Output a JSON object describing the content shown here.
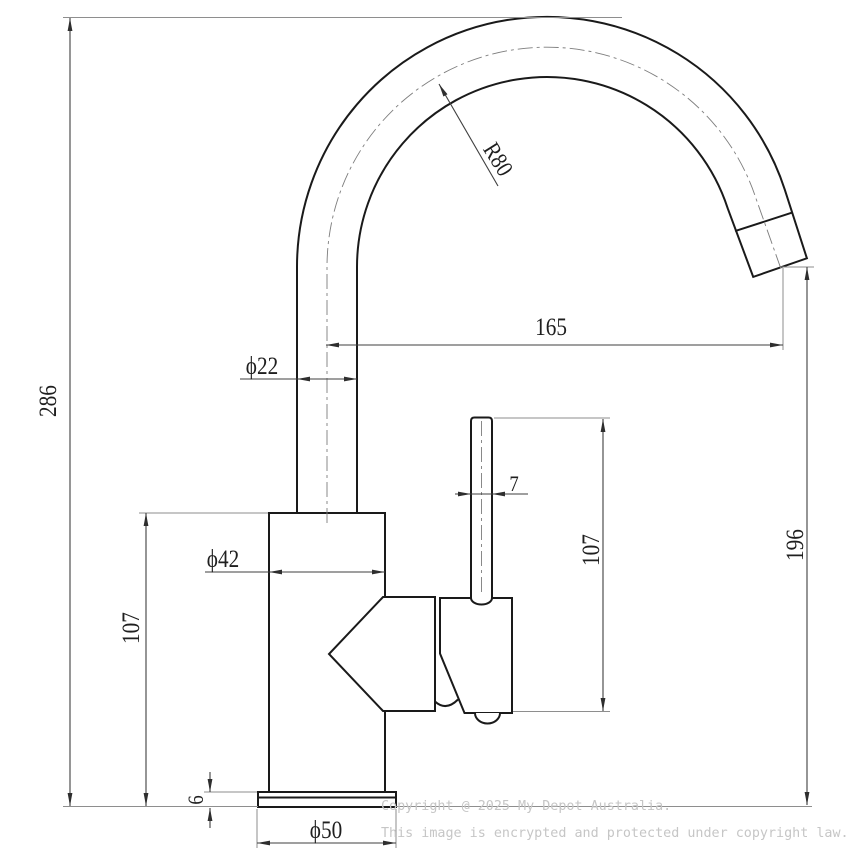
{
  "drawing": {
    "type": "technical-dimension-drawing",
    "subject": "gooseneck-mixer-tap-side-view",
    "dimensions": {
      "overall_height": "286",
      "body_height": "107",
      "base_plate_thickness": "6",
      "base_diameter": "ϕ50",
      "body_diameter": "ϕ42",
      "spout_pipe_diameter": "ϕ22",
      "spout_reach": "165",
      "spout_bend_radius": "R80",
      "lever_thickness": "7",
      "lever_height": "107",
      "outlet_height": "196"
    },
    "watermark": {
      "line1": "Copyright @ 2025 My Depot Australia.",
      "line2": "This image is encrypted and protected under copyright law."
    },
    "colors": {
      "background": "#ffffff",
      "outline": "#1a1a1a",
      "dimension_line": "#3f3f3f",
      "extension_line": "#8e8e8e",
      "watermark_text": "#c6c6c6"
    }
  }
}
